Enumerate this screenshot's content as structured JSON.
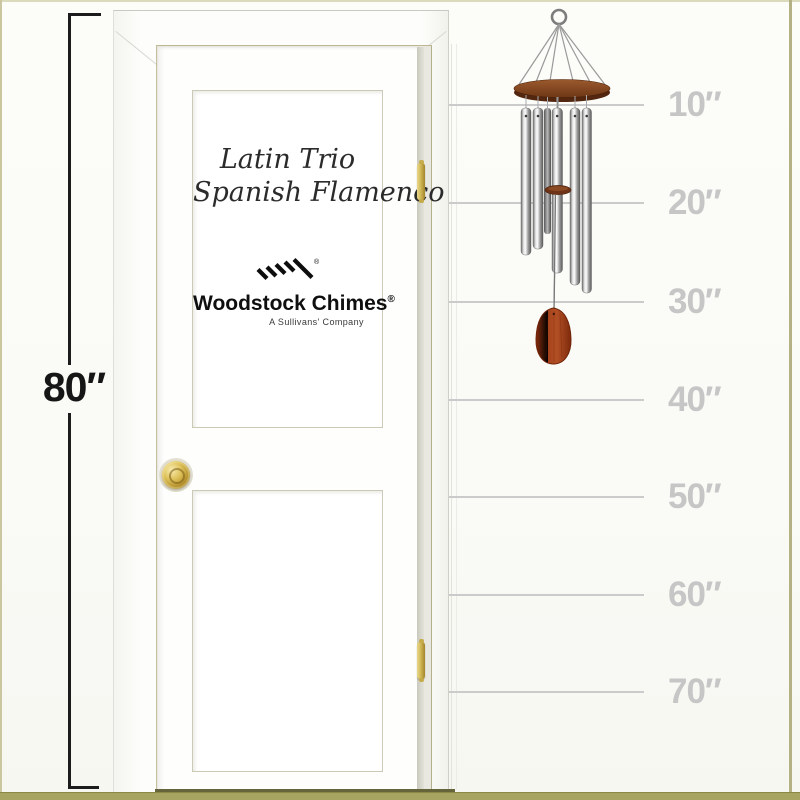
{
  "scale": {
    "door_height_label": "80″",
    "tick_labels": [
      "10″",
      "20″",
      "30″",
      "40″",
      "50″",
      "60″",
      "70″"
    ]
  },
  "door": {
    "model_line1": "Latin Trio",
    "model_line2": "Spanish Flamenco",
    "brand_name": "Woodstock Chimes",
    "registered_mark": "®",
    "brand_tagline": "A Sullivans' Company"
  },
  "chime": {
    "tube_count": 6,
    "tube_finish_color": "#c6c6c6",
    "wood_top_color": "#7a3c1c",
    "windcatcher_color": "#9c3a18"
  },
  "colors": {
    "page_background": "#fbfbf8",
    "image_border": "#a7a462",
    "tick_line": "#cbcbcb",
    "tick_text": "#c6c6c6",
    "measure_text": "#161616",
    "knob_gold": "#c9a93d"
  }
}
